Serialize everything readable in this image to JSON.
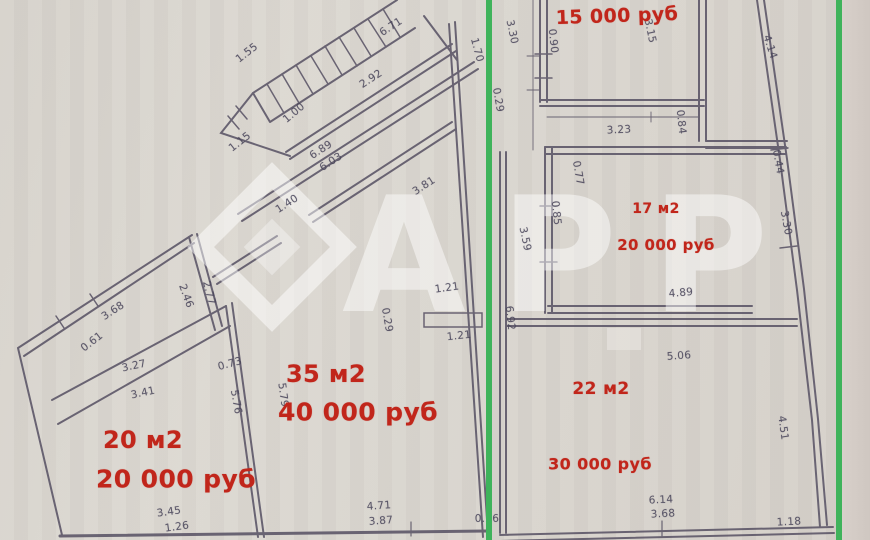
{
  "watermark": {
    "text": "АРР"
  },
  "colors": {
    "paper": "#d9d5ce",
    "paper_right_strip": "#d2cbc5",
    "wall": "#5a5466",
    "dimension_text": "#49455a",
    "price_red": "#c1261b",
    "divider_green": "#3fb35b"
  },
  "listings": [
    {
      "id": "top-right-room",
      "area": "",
      "price": "15 000 руб",
      "price_x": 617,
      "price_y": 16,
      "price_fs": 19,
      "rot": -2
    },
    {
      "id": "room-17m2",
      "area": "17 м2",
      "area_x": 656,
      "area_y": 209,
      "area_fs": 14,
      "price": "20 000 руб",
      "price_x": 666,
      "price_y": 245,
      "price_fs": 15,
      "rot": 0
    },
    {
      "id": "room-22m2",
      "area": "22 м2",
      "area_x": 601,
      "area_y": 389,
      "area_fs": 17,
      "price": "30 000 руб",
      "price_x": 600,
      "price_y": 464,
      "price_fs": 16,
      "rot": 0
    },
    {
      "id": "room-35m2",
      "area": "35 м2",
      "area_x": 326,
      "area_y": 374,
      "area_fs": 24,
      "price": "40 000 руб",
      "price_x": 358,
      "price_y": 412,
      "price_fs": 25,
      "rot": 0
    },
    {
      "id": "room-20m2",
      "area": "20 м2",
      "area_x": 143,
      "area_y": 440,
      "area_fs": 24,
      "price": "20 000 руб",
      "price_x": 176,
      "price_y": 479,
      "price_fs": 25,
      "rot": 0
    }
  ],
  "dimensions": [
    {
      "t": "1.55",
      "x": 247,
      "y": 53,
      "r": -38
    },
    {
      "t": "6.71",
      "x": 391,
      "y": 27,
      "r": -33
    },
    {
      "t": "2.92",
      "x": 371,
      "y": 79,
      "r": -33
    },
    {
      "t": "1.00",
      "x": 294,
      "y": 113,
      "r": -40
    },
    {
      "t": "1.15",
      "x": 240,
      "y": 142,
      "r": -38
    },
    {
      "t": "6.89",
      "x": 321,
      "y": 150,
      "r": -33
    },
    {
      "t": "6.03",
      "x": 331,
      "y": 162,
      "r": -33
    },
    {
      "t": "3.81",
      "x": 424,
      "y": 186,
      "r": -33
    },
    {
      "t": "1.40",
      "x": 287,
      "y": 204,
      "r": -33
    },
    {
      "t": "2.46",
      "x": 186,
      "y": 296,
      "r": 70
    },
    {
      "t": "2.77",
      "x": 209,
      "y": 293,
      "r": 75
    },
    {
      "t": "3.68",
      "x": 113,
      "y": 311,
      "r": -33
    },
    {
      "t": "0.61",
      "x": 92,
      "y": 342,
      "r": -38
    },
    {
      "t": "3.27",
      "x": 134,
      "y": 366,
      "r": -12
    },
    {
      "t": "3.41",
      "x": 143,
      "y": 393,
      "r": -12
    },
    {
      "t": "0.73",
      "x": 230,
      "y": 364,
      "r": -15
    },
    {
      "t": "5.76",
      "x": 236,
      "y": 402,
      "r": 80
    },
    {
      "t": "5.79",
      "x": 283,
      "y": 395,
      "r": 82
    },
    {
      "t": "1.70",
      "x": 477,
      "y": 50,
      "r": 75
    },
    {
      "t": "0.29",
      "x": 387,
      "y": 320,
      "r": 80
    },
    {
      "t": "1.21",
      "x": 447,
      "y": 288,
      "r": -8
    },
    {
      "t": "1.21",
      "x": 459,
      "y": 336,
      "r": -6
    },
    {
      "t": "4.71",
      "x": 379,
      "y": 506,
      "r": -4
    },
    {
      "t": "3.87",
      "x": 381,
      "y": 521,
      "r": -4
    },
    {
      "t": "0.26",
      "x": 487,
      "y": 519,
      "r": 0
    },
    {
      "t": "3.45",
      "x": 169,
      "y": 512,
      "r": -8
    },
    {
      "t": "1.26",
      "x": 177,
      "y": 527,
      "r": -8
    },
    {
      "t": "0.29",
      "x": 498,
      "y": 100,
      "r": 80
    },
    {
      "t": "3.30",
      "x": 512,
      "y": 32,
      "r": 78
    },
    {
      "t": "0.90",
      "x": 553,
      "y": 41,
      "r": 84
    },
    {
      "t": "3.15",
      "x": 650,
      "y": 31,
      "r": 78
    },
    {
      "t": "4.14",
      "x": 770,
      "y": 47,
      "r": 72
    },
    {
      "t": "3.23",
      "x": 619,
      "y": 130,
      "r": -3
    },
    {
      "t": "0.84",
      "x": 681,
      "y": 122,
      "r": 84
    },
    {
      "t": "0.77",
      "x": 578,
      "y": 173,
      "r": 80
    },
    {
      "t": "0.85",
      "x": 556,
      "y": 213,
      "r": 84
    },
    {
      "t": "3.59",
      "x": 525,
      "y": 239,
      "r": 78
    },
    {
      "t": "4.89",
      "x": 681,
      "y": 293,
      "r": -5
    },
    {
      "t": "0.44",
      "x": 778,
      "y": 162,
      "r": 80
    },
    {
      "t": "3.30",
      "x": 786,
      "y": 223,
      "r": 80
    },
    {
      "t": "5.06",
      "x": 679,
      "y": 356,
      "r": -4
    },
    {
      "t": "4.51",
      "x": 783,
      "y": 428,
      "r": 82
    },
    {
      "t": "6.92",
      "x": 510,
      "y": 318,
      "r": 84
    },
    {
      "t": "6.14",
      "x": 661,
      "y": 500,
      "r": -3
    },
    {
      "t": "3.68",
      "x": 663,
      "y": 514,
      "r": -3
    },
    {
      "t": "1.18",
      "x": 789,
      "y": 522,
      "r": -3
    }
  ]
}
